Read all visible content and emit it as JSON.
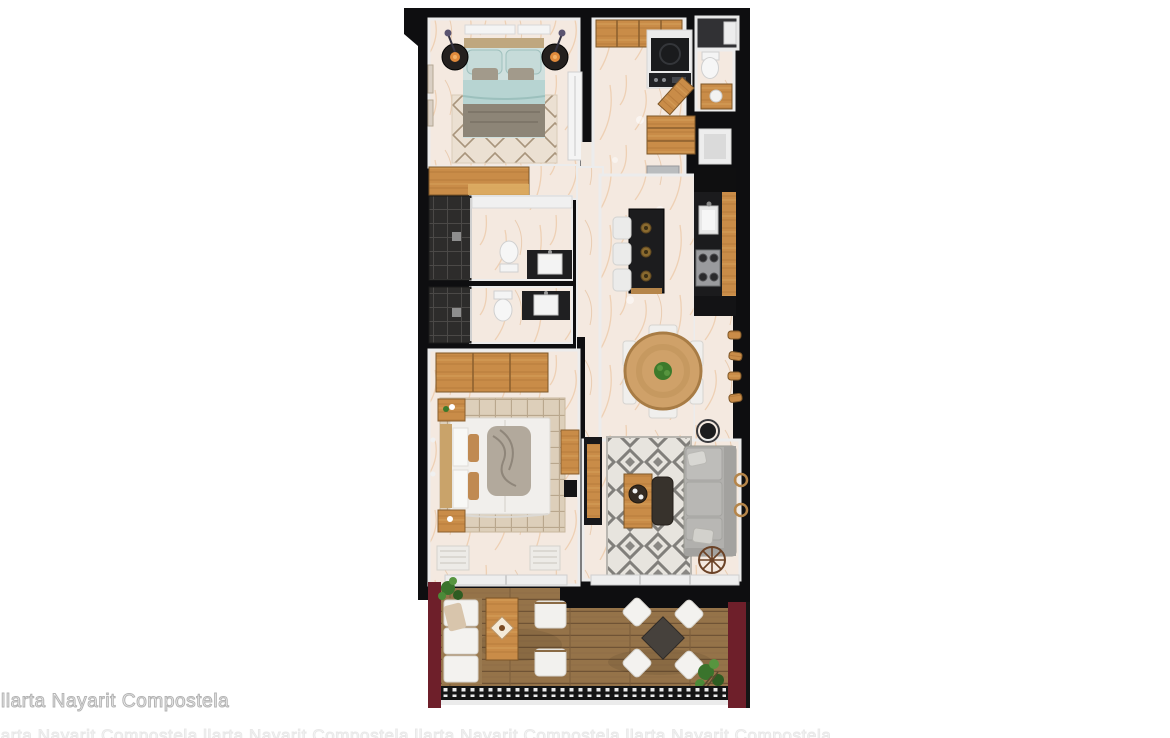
{
  "watermark": {
    "text": "llarta Nayarit Compostela",
    "edge_text": "llarta Nayarit Compostela   llarta Nayarit Compostela   llarta Nayarit Compostela   llarta Nayarit Compostela"
  },
  "palette": {
    "background": "#ffffff",
    "wall_black": "#0e0e10",
    "inner_wall_white": "#ececec",
    "marble_floor": "#f4e9e0",
    "marble_vein": "#e9bb90",
    "wood_cabinet": "#c98c48",
    "wood_table": "#cfa169",
    "deck_wood": "#957349",
    "terrace_wall_red": "#6e1f2a",
    "bedding_teal": "#b7d4d2",
    "sofa_gray": "#b1b0ad",
    "rug_pattern_gray": "#817f7b",
    "counter_dark": "#1b1b1d",
    "shower_tile_dark": "#2d2c2b",
    "plant_green": "#3c7a2b"
  },
  "floorplan": {
    "type": "residential-apartment-top-view-3d-render",
    "rooms": [
      {
        "name": "bedroom-1",
        "position": "top-left",
        "furniture": [
          "queen-bed-teal-bedding",
          "round-nightstand-left-with-lamp",
          "round-nightstand-right-with-lamp",
          "diamond-pattern-rug",
          "wall-dresser",
          "standing-mirror",
          "wood-wardrobe",
          "wall-frames"
        ]
      },
      {
        "name": "entry-hall",
        "position": "top-center",
        "furniture": [
          "wood-closet",
          "laundry-niche-washer",
          "wood-door-ajar"
        ]
      },
      {
        "name": "utility-room",
        "position": "top-right-corner",
        "furniture": [
          "white-fixture"
        ]
      },
      {
        "name": "powder-room",
        "position": "top-right",
        "furniture": [
          "toilet",
          "wood-vanity-with-sink",
          "wood-door"
        ]
      },
      {
        "name": "pantry-closet",
        "position": "right-upper",
        "furniture": [
          "wood-cabinet",
          "white-niche",
          "gray-console"
        ]
      },
      {
        "name": "bathroom-1",
        "position": "left-middle",
        "furniture": [
          "dark-tile-shower",
          "toilet",
          "dark-vanity-white-sink",
          "mirror-band"
        ]
      },
      {
        "name": "bathroom-2",
        "position": "left-middle-lower",
        "furniture": [
          "dark-tile-shower",
          "toilet",
          "dark-vanity-white-sink"
        ]
      },
      {
        "name": "kitchen",
        "position": "center-right",
        "furniture": [
          "dark-island-with-three-bowls",
          "three-white-bar-stools",
          "wall-counter-dark",
          "wood-cabinet-band",
          "sink",
          "cooktop-four-burners",
          "tall-black-unit"
        ]
      },
      {
        "name": "dining-area",
        "position": "right-middle",
        "furniture": [
          "round-wood-table",
          "green-plant-centerpiece",
          "six-white-chairs",
          "four-wood-wall-shelves"
        ]
      },
      {
        "name": "bedroom-2",
        "position": "bottom-left",
        "furniture": [
          "king-bed-white-with-gray-throw",
          "wood-headboard",
          "checkered-beige-rug",
          "wood-nightstand-top",
          "wood-nightstand-bottom",
          "wood-wardrobe",
          "wood-desk",
          "wall-tv",
          "two-white-floor-mats",
          "window-band"
        ]
      },
      {
        "name": "living-room",
        "position": "bottom-right",
        "furniture": [
          "geometric-gray-rug",
          "l-shaped-gray-sofa",
          "wood-coffee-table-with-tray",
          "dark-ottoman",
          "tv-console",
          "black-floor-lamp",
          "decor-wheel",
          "two-wood-wall-rings",
          "window-band"
        ]
      },
      {
        "name": "terrace",
        "position": "bottom",
        "furniture": [
          "wood-deck",
          "red-side-walls",
          "white-outdoor-sofa",
          "wood-outdoor-coffee-table",
          "two-white-armchairs",
          "square-dark-outdoor-table",
          "four-white-outdoor-chairs",
          "potted-plant-top-left",
          "potted-plant-bottom-right",
          "balustrade-railing"
        ]
      }
    ]
  }
}
